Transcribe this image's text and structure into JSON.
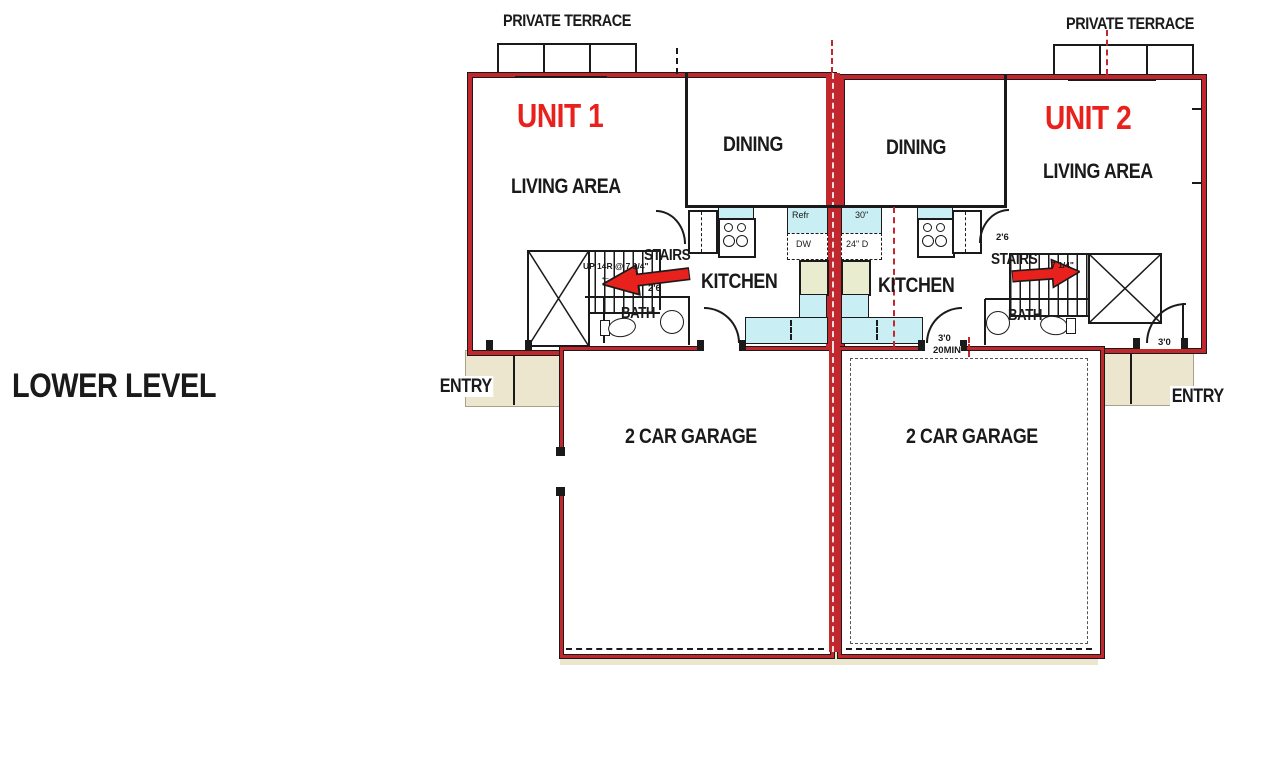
{
  "plan_title": "LOWER LEVEL",
  "colors": {
    "wall_red": "#c1272d",
    "accent_red": "#e8211d",
    "counter_cyan": "#c9eef4",
    "fixture_khaki": "#e9ecce",
    "pad_beige": "#ede6cf",
    "line_black": "#1a1a1a"
  },
  "unit1": {
    "name": "UNIT 1",
    "terrace_label": "PRIVATE TERRACE",
    "living_label": "LIVING AREA",
    "dining_label": "DINING",
    "kitchen_label": "KITCHEN",
    "stairs_label": "STAIRS",
    "stairs_note": "UP 14R @ 7 1/4\"",
    "stairs_arrow_glyph": "←",
    "stairs_width": "2'6",
    "bath_label": "BATH",
    "entry_label": "ENTRY",
    "garage_label": "2 CAR GARAGE",
    "refrigerator_label": "Refr",
    "dishwasher_label": "DW"
  },
  "unit2": {
    "name": "UNIT 2",
    "terrace_label": "PRIVATE TERRACE",
    "living_label": "LIVING AREA",
    "dining_label": "DINING",
    "kitchen_label": "KITCHEN",
    "stairs_label": "STAIRS",
    "stairs_note": "7 1/4\"",
    "door_width": "2'6",
    "bath_label": "BATH",
    "entry_label": "ENTRY",
    "entry_door_width": "3'0",
    "garage_label": "2 CAR GARAGE",
    "garage_door_width": "3'0",
    "garage_door_rating": "20MIN",
    "range_label": "30\"",
    "dishwasher_label": "24\" D"
  }
}
